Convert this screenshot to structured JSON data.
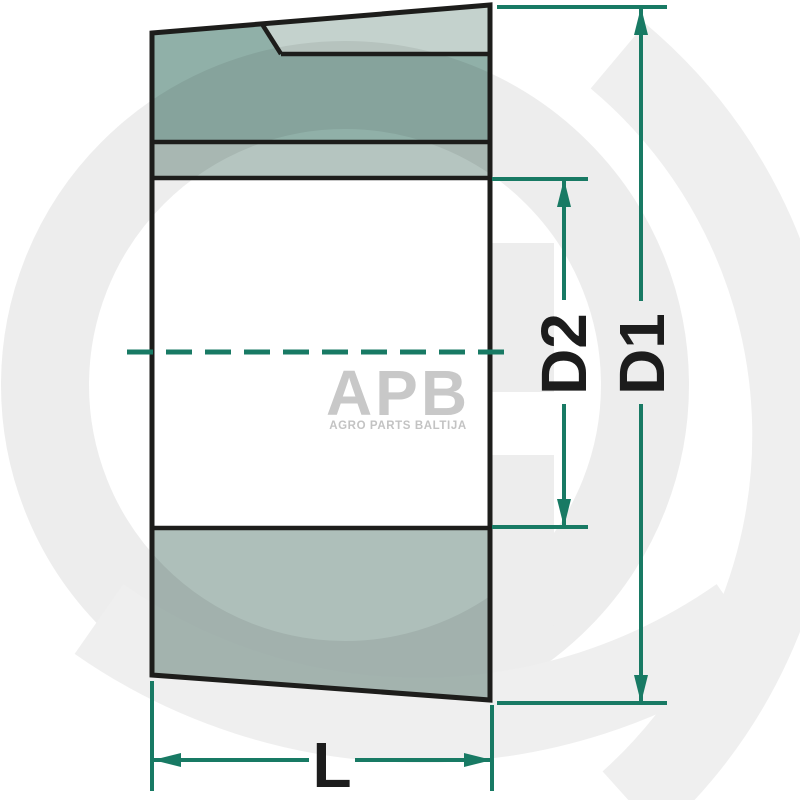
{
  "diagram": {
    "type": "technical-drawing",
    "dimension_labels": {
      "d1": "D1",
      "d2": "D2",
      "length": "L"
    },
    "colors": {
      "dimension_line_teal": "#187a64",
      "outline_black": "#1d1d1b",
      "section_dark_green": "#90b0a8",
      "section_band_green": "#b5c5c0",
      "section_bottom_green": "#aebfba",
      "slit_light_green": "#c4d2cd",
      "watermark_gray": "#ededed",
      "logo_gray": "#c8c8c8"
    }
  },
  "watermark": {
    "brand": "APB",
    "tagline": "AGRO PARTS BALTIJA"
  }
}
